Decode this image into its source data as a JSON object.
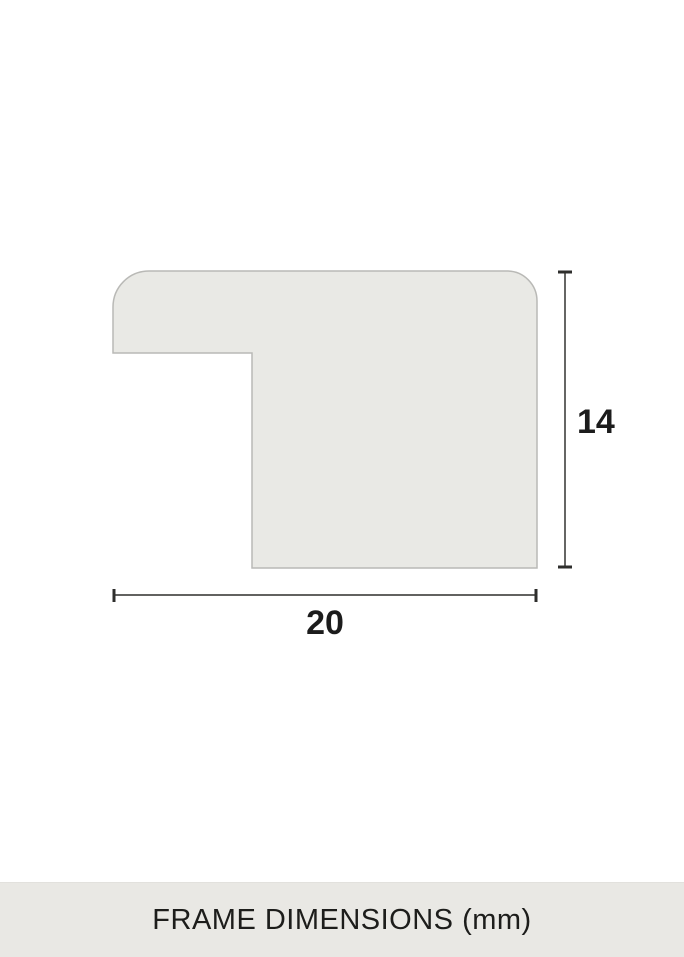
{
  "page": {
    "background_color": "#ffffff"
  },
  "diagram": {
    "type": "frame-profile-cross-section",
    "unit": "mm",
    "profile": {
      "fill": "#e9e9e5",
      "stroke": "#b9b9b6"
    },
    "dimensions": {
      "height": {
        "value": 14,
        "label": "14",
        "orientation": "vertical"
      },
      "width": {
        "value": 20,
        "label": "20",
        "orientation": "horizontal"
      }
    },
    "dimension_line_color": "#4b4b49",
    "dimension_cap_color": "#2e2e2c",
    "label_color": "#1c1c1c"
  },
  "footer": {
    "label": "FRAME DIMENSIONS (mm)",
    "background_color": "#e9e8e4",
    "text_color": "#1d1d1b"
  }
}
